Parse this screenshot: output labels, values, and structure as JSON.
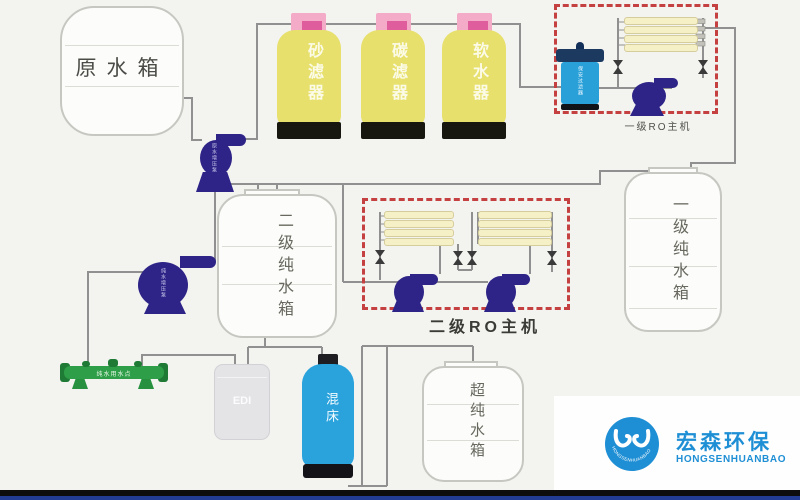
{
  "diagram": {
    "tanks": {
      "raw": {
        "label": "原水箱"
      },
      "stage2_pure": {
        "label": "二级纯水箱"
      },
      "stage1_pure": {
        "label": "一级纯水箱"
      },
      "ultra_pure": {
        "label": "超纯水箱"
      }
    },
    "filters": {
      "sand": {
        "label": "砂滤器"
      },
      "carbon": {
        "label": "碳滤器"
      },
      "softener": {
        "label": "软水器"
      }
    },
    "ro_units": {
      "stage1": {
        "label": "一级RO主机"
      },
      "stage2": {
        "label": "二级RO主机"
      }
    },
    "pumps": {
      "raw_booster": {
        "label": "原水增压泵"
      },
      "transfer": {
        "label": "纯水增压泵"
      }
    },
    "components": {
      "cartridge_filter": {
        "label": "保安过滤器"
      },
      "edi": {
        "label": "EDI"
      },
      "mixed_bed": {
        "label": "混床"
      },
      "use_point_manifold": {
        "label": "纯水用水点"
      }
    }
  },
  "logo": {
    "cn": "宏森环保",
    "en": "HONGSENHUANBAO",
    "mark_text": "HONGSENHUANBAO"
  },
  "colors": {
    "ro_box_dash": "#c54040",
    "filter_yellow": "#e7e06d",
    "filter_cap_pink": "#f4abc8",
    "pump_navy": "#2e2487",
    "cartridge_blue": "#2aa0d8",
    "mixed_bed_blue": "#2aa3dd",
    "manifold_green": "#2e9e48",
    "logo_blue": "#1f8fd5",
    "pipe_gray": "#909090"
  }
}
